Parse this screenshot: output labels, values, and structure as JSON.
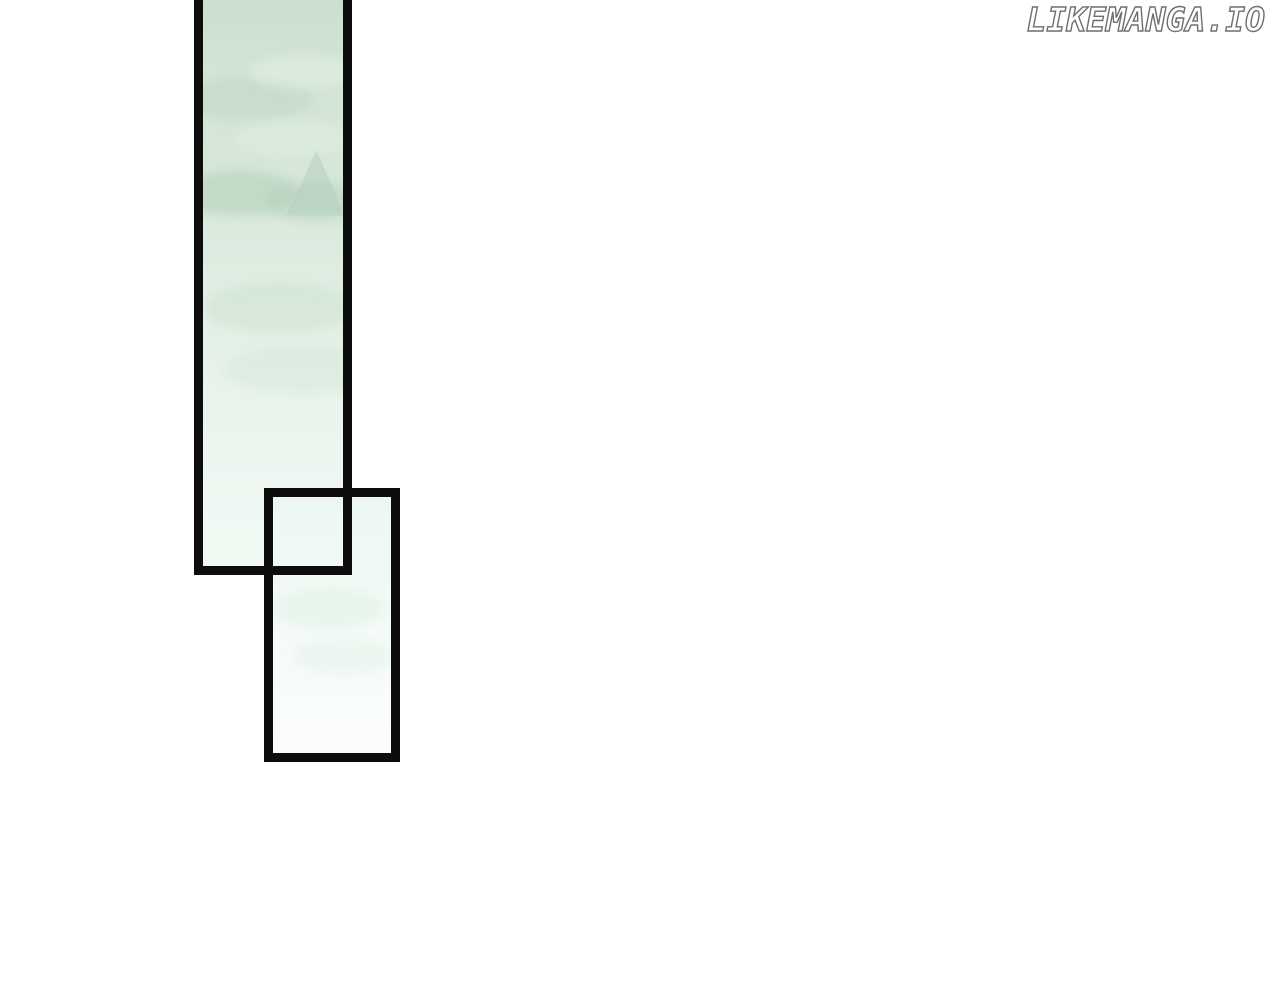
{
  "page": {
    "background_color": "#ffffff"
  },
  "watermark": {
    "text": "LIKEMANGA.IO",
    "fill_color": "#ffffff",
    "outline_color": "#6f6f6f"
  },
  "panels": [
    {
      "name": "tall-sky-panel",
      "border_color": "#0d0d0d",
      "fill_top_color": "#ccdfce",
      "fill_bottom_color": "#f1f9f3",
      "art": "pale mint watercolor sky wash with faint cloud bands and a distant peak silhouette, cropped at top edge of page"
    },
    {
      "name": "small-overlap-panel",
      "border_color": "#0d0d0d",
      "fill_top_color": "#ecf6f0",
      "fill_bottom_color": "#fbfdfc",
      "art": "near-white pale mint wash, frame overlaps bottom-right of tall panel"
    }
  ]
}
